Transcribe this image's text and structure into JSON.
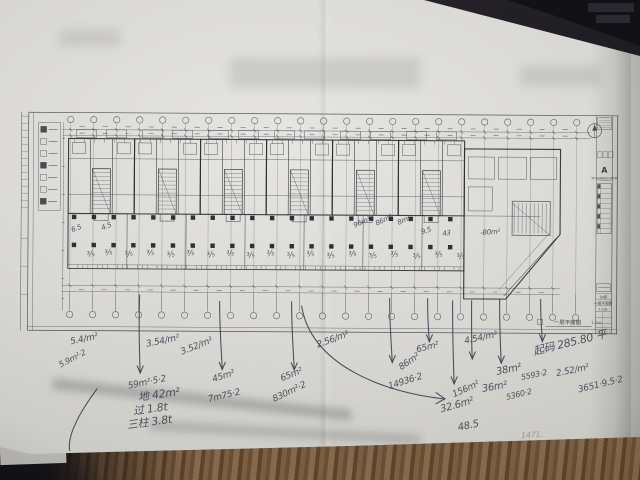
{
  "colors": {
    "paper": "#d9d8d4",
    "print": "#4a4a50",
    "wall": "#2c2c31",
    "ink": "#39404f",
    "pencil": "#8f8d86",
    "desk": "#27252b",
    "wood": "#6a4e34"
  },
  "titleblock": {
    "logo": "A",
    "firm": "浙江省建筑设计研究院",
    "block": "1A座",
    "sheet_title": "一层平面图",
    "scale": "1:100"
  },
  "plan_label": {
    "title": "一层平面图",
    "scale": "1:100"
  },
  "plan_marks": [
    {
      "t": "6.5",
      "x": 70,
      "y": 228,
      "s": 7,
      "r": -20
    },
    {
      "t": "4.5",
      "x": 100,
      "y": 226,
      "s": 7,
      "r": -22
    },
    {
      "t": "96m²",
      "x": 352,
      "y": 222,
      "s": 7,
      "r": -24
    },
    {
      "t": "86m²",
      "x": 374,
      "y": 220,
      "s": 7,
      "r": -26
    },
    {
      "t": "8m²",
      "x": 396,
      "y": 219,
      "s": 7,
      "r": -24
    },
    {
      "t": "9.5",
      "x": 420,
      "y": 228,
      "s": 7,
      "r": -18
    },
    {
      "t": "43",
      "x": 442,
      "y": 229,
      "s": 7,
      "r": -6
    },
    {
      "t": "-80m²",
      "x": 480,
      "y": 228,
      "s": 7,
      "r": -4
    },
    {
      "t": "⅗",
      "x": 86,
      "y": 252,
      "s": 8,
      "r": -14
    },
    {
      "t": "⅗",
      "x": 104,
      "y": 250,
      "s": 8,
      "r": -10
    },
    {
      "t": "⅗",
      "x": 124,
      "y": 252,
      "s": 8,
      "r": -18
    },
    {
      "t": "⅗",
      "x": 146,
      "y": 250,
      "s": 8,
      "r": -8
    },
    {
      "t": "⅗",
      "x": 166,
      "y": 252,
      "s": 8,
      "r": -14
    },
    {
      "t": "⅗",
      "x": 186,
      "y": 250,
      "s": 8,
      "r": -10
    },
    {
      "t": "⅗",
      "x": 206,
      "y": 252,
      "s": 8,
      "r": -16
    },
    {
      "t": "⅗",
      "x": 226,
      "y": 250,
      "s": 8,
      "r": -8
    },
    {
      "t": "⅗",
      "x": 246,
      "y": 252,
      "s": 8,
      "r": -12
    },
    {
      "t": "⅗",
      "x": 266,
      "y": 250,
      "s": 8,
      "r": -10
    },
    {
      "t": "⅗",
      "x": 286,
      "y": 252,
      "s": 8,
      "r": -15
    },
    {
      "t": "⅗",
      "x": 306,
      "y": 250,
      "s": 8,
      "r": -9
    },
    {
      "t": "⅗",
      "x": 326,
      "y": 252,
      "s": 8,
      "r": -13
    },
    {
      "t": "⅗",
      "x": 348,
      "y": 250,
      "s": 8,
      "r": -11
    },
    {
      "t": "⅗",
      "x": 368,
      "y": 252,
      "s": 8,
      "r": -15
    },
    {
      "t": "⅗",
      "x": 390,
      "y": 250,
      "s": 8,
      "r": -9
    },
    {
      "t": "⅗",
      "x": 412,
      "y": 252,
      "s": 8,
      "r": -13
    },
    {
      "t": "⅗",
      "x": 434,
      "y": 250,
      "s": 8,
      "r": -10
    },
    {
      "t": "⅗",
      "x": 456,
      "y": 252,
      "s": 8,
      "r": -14
    }
  ],
  "notes": [
    {
      "t": "5.4/m²",
      "x": 70,
      "y": 339,
      "s": 9,
      "r": -12
    },
    {
      "t": "5.9m²·2",
      "x": 58,
      "y": 363,
      "s": 8,
      "r": -28
    },
    {
      "t": "59m²·5·2",
      "x": 128,
      "y": 383,
      "s": 9,
      "r": -12
    },
    {
      "t": "3.54/m²",
      "x": 146,
      "y": 341,
      "s": 9,
      "r": -12
    },
    {
      "t": "3.52/m²",
      "x": 180,
      "y": 349,
      "s": 9,
      "r": -22
    },
    {
      "t": "地 42m²",
      "x": 138,
      "y": 390,
      "s": 11,
      "r": -8
    },
    {
      "t": "过 1.8t",
      "x": 133,
      "y": 404,
      "s": 11,
      "r": -8
    },
    {
      "t": "三柱 3.8t",
      "x": 127,
      "y": 418,
      "s": 11,
      "r": -8
    },
    {
      "t": "45m²",
      "x": 212,
      "y": 376,
      "s": 9,
      "r": -18
    },
    {
      "t": "7m75·2",
      "x": 208,
      "y": 396,
      "s": 9,
      "r": -14
    },
    {
      "t": "65m²",
      "x": 280,
      "y": 375,
      "s": 9,
      "r": -22
    },
    {
      "t": "830m²·2",
      "x": 272,
      "y": 396,
      "s": 9,
      "r": -26
    },
    {
      "t": "2.56/m²",
      "x": 316,
      "y": 341,
      "s": 9,
      "r": -20
    },
    {
      "t": "65m²",
      "x": 416,
      "y": 345,
      "s": 9,
      "r": -14
    },
    {
      "t": "86m²",
      "x": 398,
      "y": 364,
      "s": 9,
      "r": -35
    },
    {
      "t": "14936·2",
      "x": 388,
      "y": 382,
      "s": 9,
      "r": -18
    },
    {
      "t": "4.54/m²",
      "x": 464,
      "y": 336,
      "s": 9,
      "r": -12
    },
    {
      "t": "156m²",
      "x": 452,
      "y": 390,
      "s": 9,
      "r": -24
    },
    {
      "t": "32.6m²",
      "x": 440,
      "y": 404,
      "s": 10,
      "r": -16
    },
    {
      "t": "48.5",
      "x": 458,
      "y": 422,
      "s": 10,
      "r": -12
    },
    {
      "t": "38m²",
      "x": 496,
      "y": 366,
      "s": 10,
      "r": -12
    },
    {
      "t": "5593·2",
      "x": 521,
      "y": 372,
      "s": 8,
      "r": -12
    },
    {
      "t": "2.52/m²",
      "x": 556,
      "y": 368,
      "s": 9,
      "r": -12
    },
    {
      "t": "36m²",
      "x": 482,
      "y": 383,
      "s": 10,
      "r": -10
    },
    {
      "t": "5360·2",
      "x": 506,
      "y": 392,
      "s": 8,
      "r": -14
    },
    {
      "t": "起码 285.80 平",
      "x": 532,
      "y": 342,
      "s": 11,
      "r": -14
    },
    {
      "t": "3651·9.5·2",
      "x": 578,
      "y": 384,
      "s": 9,
      "r": -14
    },
    {
      "t": "1471.",
      "x": 522,
      "y": 430,
      "s": 8,
      "r": -4,
      "c": "pencil"
    }
  ]
}
